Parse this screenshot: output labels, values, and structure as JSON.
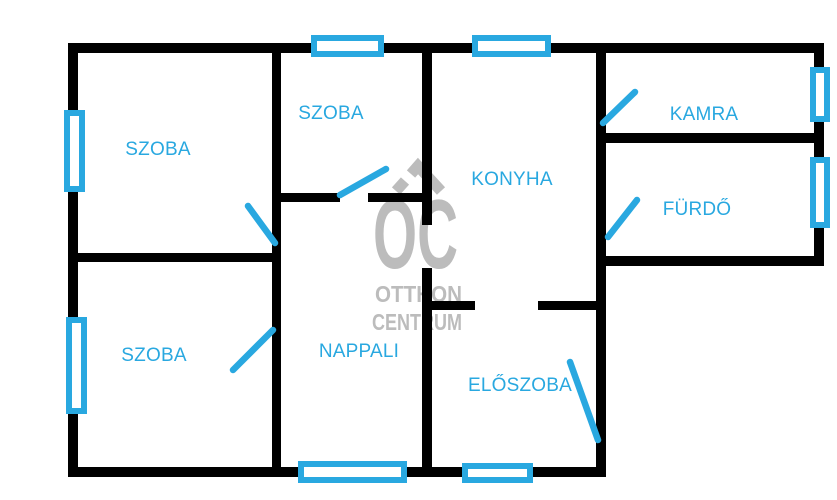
{
  "meta": {
    "width": 837,
    "height": 500,
    "background": "#ffffff"
  },
  "colors": {
    "wall": "#000000",
    "accent": "#29a8e0",
    "watermark": "#bcbcbc",
    "window_fill": "#ffffff"
  },
  "rooms": [
    {
      "id": "szoba-top-left",
      "label": "SZOBA",
      "cx": 158,
      "cy": 150
    },
    {
      "id": "szoba-middle",
      "label": "SZOBA",
      "cx": 331,
      "cy": 114
    },
    {
      "id": "konyha",
      "label": "KONYHA",
      "cx": 512,
      "cy": 180
    },
    {
      "id": "kamra",
      "label": "KAMRA",
      "cx": 704,
      "cy": 115
    },
    {
      "id": "furdo",
      "label": "FÜRDŐ",
      "cx": 697,
      "cy": 210
    },
    {
      "id": "szoba-bottom-left",
      "label": "SZOBA",
      "cx": 154,
      "cy": 356
    },
    {
      "id": "nappali",
      "label": "NAPPALI",
      "cx": 359,
      "cy": 352
    },
    {
      "id": "eloszoba",
      "label": "ELŐSZOBA",
      "cx": 520,
      "cy": 386
    }
  ],
  "walls": [
    {
      "name": "wall-outer-top",
      "x": 70,
      "y": 43,
      "w": 752,
      "h": 10
    },
    {
      "name": "wall-outer-left",
      "x": 68,
      "y": 43,
      "w": 10,
      "h": 434
    },
    {
      "name": "wall-outer-right-wing",
      "x": 814,
      "y": 43,
      "w": 10,
      "h": 223
    },
    {
      "name": "wall-wing-bottom",
      "x": 597,
      "y": 256,
      "w": 227,
      "h": 10
    },
    {
      "name": "wall-center-vertical",
      "x": 596,
      "y": 43,
      "w": 10,
      "h": 434
    },
    {
      "name": "wall-outer-bottom",
      "x": 68,
      "y": 467,
      "w": 538,
      "h": 10
    },
    {
      "name": "wall-middle-vertical",
      "x": 272,
      "y": 43,
      "w": 9,
      "h": 434
    },
    {
      "name": "wall-left-rooms-divider",
      "x": 68,
      "y": 253,
      "w": 213,
      "h": 9
    },
    {
      "name": "wall-szoba-middle-bottom-left",
      "x": 272,
      "y": 193,
      "w": 68,
      "h": 9
    },
    {
      "name": "wall-szoba-middle-bottom-right",
      "x": 368,
      "y": 193,
      "w": 64,
      "h": 9
    },
    {
      "name": "wall-nappali-konyha-upper",
      "x": 422,
      "y": 43,
      "w": 10,
      "h": 182
    },
    {
      "name": "wall-nappali-eloszoba-lower",
      "x": 422,
      "y": 268,
      "w": 10,
      "h": 209
    },
    {
      "name": "wall-kamra-furdo-divider",
      "x": 596,
      "y": 133,
      "w": 228,
      "h": 10
    },
    {
      "name": "wall-eloszoba-top-left",
      "x": 422,
      "y": 301,
      "w": 53,
      "h": 9
    },
    {
      "name": "wall-eloszoba-top-right",
      "x": 538,
      "y": 301,
      "w": 64,
      "h": 9
    }
  ],
  "windows": [
    {
      "name": "window-top-szoba-middle",
      "x": 311,
      "y": 35,
      "w": 73,
      "h": 22
    },
    {
      "name": "window-top-konyha",
      "x": 472,
      "y": 35,
      "w": 79,
      "h": 22
    },
    {
      "name": "window-left-szoba-top",
      "x": 64,
      "y": 110,
      "w": 21,
      "h": 82
    },
    {
      "name": "window-left-szoba-bottom",
      "x": 66,
      "y": 317,
      "w": 21,
      "h": 97
    },
    {
      "name": "window-right-kamra",
      "x": 810,
      "y": 67,
      "w": 20,
      "h": 55
    },
    {
      "name": "window-right-furdo",
      "x": 810,
      "y": 157,
      "w": 20,
      "h": 71
    },
    {
      "name": "window-bottom-nappali",
      "x": 298,
      "y": 461,
      "w": 109,
      "h": 22
    },
    {
      "name": "window-bottom-eloszoba",
      "x": 462,
      "y": 463,
      "w": 71,
      "h": 20
    }
  ],
  "doors": [
    {
      "name": "door-szoba-middle",
      "x1": 340,
      "y1": 195,
      "x2": 386,
      "y2": 169
    },
    {
      "name": "door-szoba-top-left",
      "x1": 248,
      "y1": 206,
      "x2": 275,
      "y2": 243
    },
    {
      "name": "door-szoba-bottom-left",
      "x1": 233,
      "y1": 370,
      "x2": 273,
      "y2": 330
    },
    {
      "name": "door-kamra",
      "x1": 603,
      "y1": 123,
      "x2": 635,
      "y2": 92
    },
    {
      "name": "door-furdo",
      "x1": 608,
      "y1": 237,
      "x2": 637,
      "y2": 200
    },
    {
      "name": "door-entry-eloszoba",
      "x1": 570,
      "y1": 362,
      "x2": 598,
      "y2": 440
    }
  ],
  "watermark": {
    "oc": "OC",
    "otthon": "OTTHON",
    "centrum": "CENTRUM"
  }
}
